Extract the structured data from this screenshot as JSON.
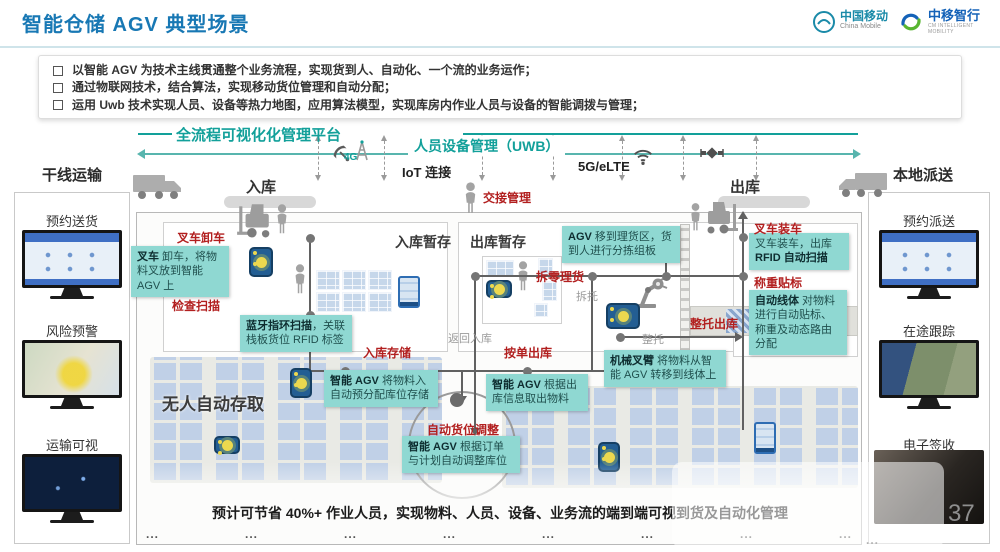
{
  "header": {
    "title": "智能仓储 AGV 典型场景",
    "logo_cmcc": {
      "name": "中国移动",
      "sub": "China Mobile"
    },
    "logo_cmi": {
      "name": "中移智行",
      "sub": "CM INTELLIGENT MOBILITY"
    }
  },
  "bullets": [
    "以智能 AGV 为技术主线贯通整个业务流程，实现货到人、自动化、一个流的业务运作；",
    "通过物联网技术，结合算法，实现移动货位管理和自动分配；",
    "运用 Uwb 技术实现人员、设备等热力地图，应用算法模型，实现库房内作业人员与设备的智能调拨与管理；"
  ],
  "platform": {
    "title": "全流程可视化化管理平台",
    "uwb_label": "人员设备管理（UWB）",
    "iot_label": "IoT 连接",
    "net_label": "5G/eLTE",
    "icon_4g": "4G"
  },
  "flow": {
    "inbound": "入库",
    "outbound": "出库",
    "handover": "交接管理",
    "inbound_staging": "入库暂存",
    "outbound_staging": "出库暂存",
    "auto_storage": "无人自动存取",
    "forklift_unload": "叉车卸车",
    "check_scan": "检查扫描",
    "inbound_store": "入库存储",
    "order_outbound": "按单出库",
    "piece_picking": "拆零理货",
    "pallet_outbound": "整托出库",
    "forklift_load": "叉车装车",
    "weigh_label": "称重贴标",
    "slot_adjust": "自动货位调整",
    "return_inbound": "返回入库",
    "depalletize": "拆托",
    "palletize": "整托"
  },
  "callouts": {
    "unload": {
      "pre": "",
      "bold": "叉车",
      "post": " 卸车，将物料叉放到智能 AGV 上"
    },
    "bluetooth": {
      "pre": "",
      "bold": "蓝牙指环扫描",
      "post": "，关联栈板货位 RFID 标签"
    },
    "agv_pick": {
      "pre": "",
      "bold": "AGV",
      "post": " 移到理货区，货到人进行分拣组板"
    },
    "robot_arm": {
      "pre": "",
      "bold": "机械叉臂",
      "post": " 将物料从智能 AGV 转移到线体上"
    },
    "rfid": {
      "pre": "叉车装车，出库 ",
      "bold": "RFID 自动扫描",
      "post": ""
    },
    "auto_line": {
      "pre": "",
      "bold": "自动线体",
      "post": " 对物料进行自动贴标、称重及动态路由分配"
    },
    "agv_store": {
      "pre": "",
      "bold": "智能 AGV",
      "post": " 将物料入自动预分配库位存储"
    },
    "agv_retrieve": {
      "pre": "",
      "bold": "智能 AGV",
      "post": " 根据出库信息取出物料"
    },
    "agv_adjust": {
      "pre": "",
      "bold": "智能 AGV",
      "post": " 根据订单与计划自动调整库位"
    }
  },
  "sidebar_left": {
    "title": "干线运输",
    "items": [
      "预约送货",
      "风险预警",
      "运输可视"
    ]
  },
  "sidebar_right": {
    "title": "本地派送",
    "items": [
      "预约派送",
      "在途跟踪",
      "电子签收"
    ]
  },
  "summary": "预计可节省 40%+ 作业人员，实现物料、人员、设备、业务流的端到端可视到货及自动化管理",
  "misc": {
    "dots": "...",
    "page_number": "37"
  },
  "icons": {
    "satellite_dish": "dish shape",
    "satellite": "diamond+panels",
    "wifi": "arcs",
    "antenna_4g": "mast + 4G",
    "person": "head+body",
    "truck": "box truck",
    "forklift": "mast+fork",
    "robot_arm": "articulated arm",
    "agv": "blue cart with yellow disc"
  },
  "colors": {
    "title_blue": "#1878b4",
    "accent_teal": "#12a09a",
    "callout_bg": "#8fd8d2",
    "red_label": "#b21f1f",
    "line_gray": "#616161",
    "rack_blue": "#bdcee6"
  }
}
